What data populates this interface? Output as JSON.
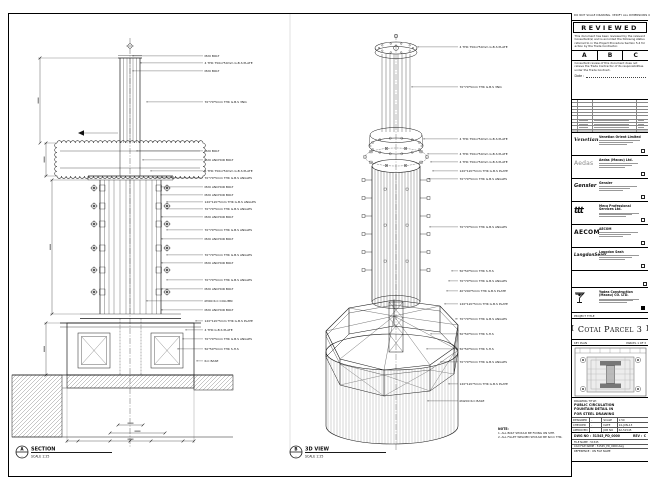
{
  "sheet_note": "DO NOT SCALE DRAWING. VERIFY ALL DIMENSIONS ON SITE.",
  "stamp": {
    "title": "REVIEWED",
    "para1": "This document has been reviewed by the relevant Consultant(s) and is accorded the following status referred to in the Project Procedure Section 5.4 for action by the Trade Contractor.",
    "options": [
      "A",
      "B",
      "C"
    ],
    "para2": "Consultant review of this document does not relieve the Trade Contractor of its responsibilities under the Trade Contract.",
    "date_label": "Date :"
  },
  "consultants": [
    {
      "logo": "Venetian",
      "name": "Venetian Orient Limited"
    },
    {
      "logo": "Aedas",
      "name": "Aedas (Macau) Ltd."
    },
    {
      "logo": "Gensler",
      "name": "Gensler"
    },
    {
      "logo": "ttt",
      "name": "Meca Professional Services Ltd."
    },
    {
      "logo": "AECOM",
      "name": "AECOM"
    },
    {
      "logo": "LangdonSeah",
      "name": "Langdon Seah"
    }
  ],
  "contractor": {
    "name": "Yadea Construction (Macau) CO. LTD."
  },
  "project": {
    "label": "PROJECT TITLE",
    "title": "Cotai Parcel 3"
  },
  "key_plan": {
    "label": "KEY PLAN",
    "caption": "PARCEL 1 OF 3"
  },
  "title_block": {
    "title_label": "DRAWING TITLE:",
    "title_lines": [
      "PUBLIC CIRCULATION",
      "FOUNTAIN DETAIL IN",
      "FOR STEEL DRAWING"
    ],
    "fields": [
      {
        "l": "DESIGNED",
        "lv": "-",
        "r": "SCALE",
        "rv": "1:50"
      },
      {
        "l": "CHECKED",
        "lv": "-",
        "r": "DATE",
        "rv": "14-JUN-13"
      },
      {
        "l": "APPROVED",
        "lv": "-",
        "r": "JOB NO",
        "rv": "62-51545"
      }
    ],
    "dwg_label": "DWG NO :",
    "dwg_no": "51545_PD_0000",
    "rev_label": "REV :",
    "rev": "C",
    "file_label": "FILE NAME :",
    "file": "51545",
    "cad_label": "CAD FILE NAME :",
    "cad": "51545_PD_0000.dwg",
    "ref_label": "REFERENCE :",
    "ref": "ON FILE NAME"
  },
  "views": {
    "section": {
      "bubble": "A",
      "title": "SECTION",
      "scale": "SCALE 1:25",
      "labels": [
        "M20 BOLT",
        "4 THK 750x750mm G.B.S PLATE",
        "M20 BOLT",
        "70*70*5mm THK G.B.S 3NO.",
        "M20 BOLT",
        "M20 ANCHOR BOLT",
        "4 THK 750x750mm G.B.S PLATE",
        "70*70*5mm THK G.B.S ANGLES",
        "M20 ANCHOR BOLT",
        "M20 ANCHOR BOLT",
        "120*120*5mm THK G.B.S ANGLES",
        "70*70*5mm THK G.B.S ANGLES",
        "M20 ANCHOR BOLT",
        "70*70*5mm THK G.B.S ANGLES",
        "M20 ANCHOR BOLT",
        "70*70*5mm THK G.B.S ANGLES",
        "M20 ANCHOR BOLT",
        "70*70*5mm THK G.B.S ANGLES",
        "M20 ANCHOR BOLT",
        "Ø300 R.C COLUMN",
        "M20 ANCHOR BOLT",
        "120*120*5mm THK G.B.S PLATE",
        "4 THK G.B.S PLATE",
        "70*70*5mm THK G.B.S ANGLES",
        "50*50*5mm THK S.H.S",
        "R.C BASE"
      ]
    },
    "iso": {
      "bubble": "B",
      "title": "3D VIEW",
      "scale": "SCALE 1:25",
      "labels": [
        "4 THK 750x750mm G.B.S PLATE",
        "70*70*5mm THK G.B.S 3NO.",
        "4 THK 750x750mm G.B.S PLATE",
        "4 THK 750x750mm G.B.S PLATE",
        "4 THK 750x750mm G.B.S PLATE",
        "120*120*5mm THK G.B.S PLATE",
        "70*70*5mm THK G.B.S ANGLES",
        "70*70*5mm THK G.B.S ANGLES",
        "50*50*5mm THK S.H.S",
        "70*70*5mm THK G.B.S ANGLES",
        "40*200*5mm THK G.B.S PLATE",
        "120*120*5mm THK G.B.S PLATE",
        "70*70*5mm THK G.B.S ANGLES",
        "50*50*5mm THK S.H.S",
        "50*50*5mm THK S.H.S",
        "70*70*5mm THK G.B.S ANGLES",
        "120*120*5mm THK G.B.S PLATE",
        "Ø4200 R.C BASE"
      ]
    }
  },
  "note": {
    "title": "NOTE:",
    "lines": [
      "1. ALL BOLT SHOULD BE FIXING ON SITE.",
      "2. ALL FILLET WELDED SHOULD BE 6mm THK."
    ]
  },
  "colors": {
    "line": "#1a1a1a",
    "paper": "#ffffff"
  }
}
